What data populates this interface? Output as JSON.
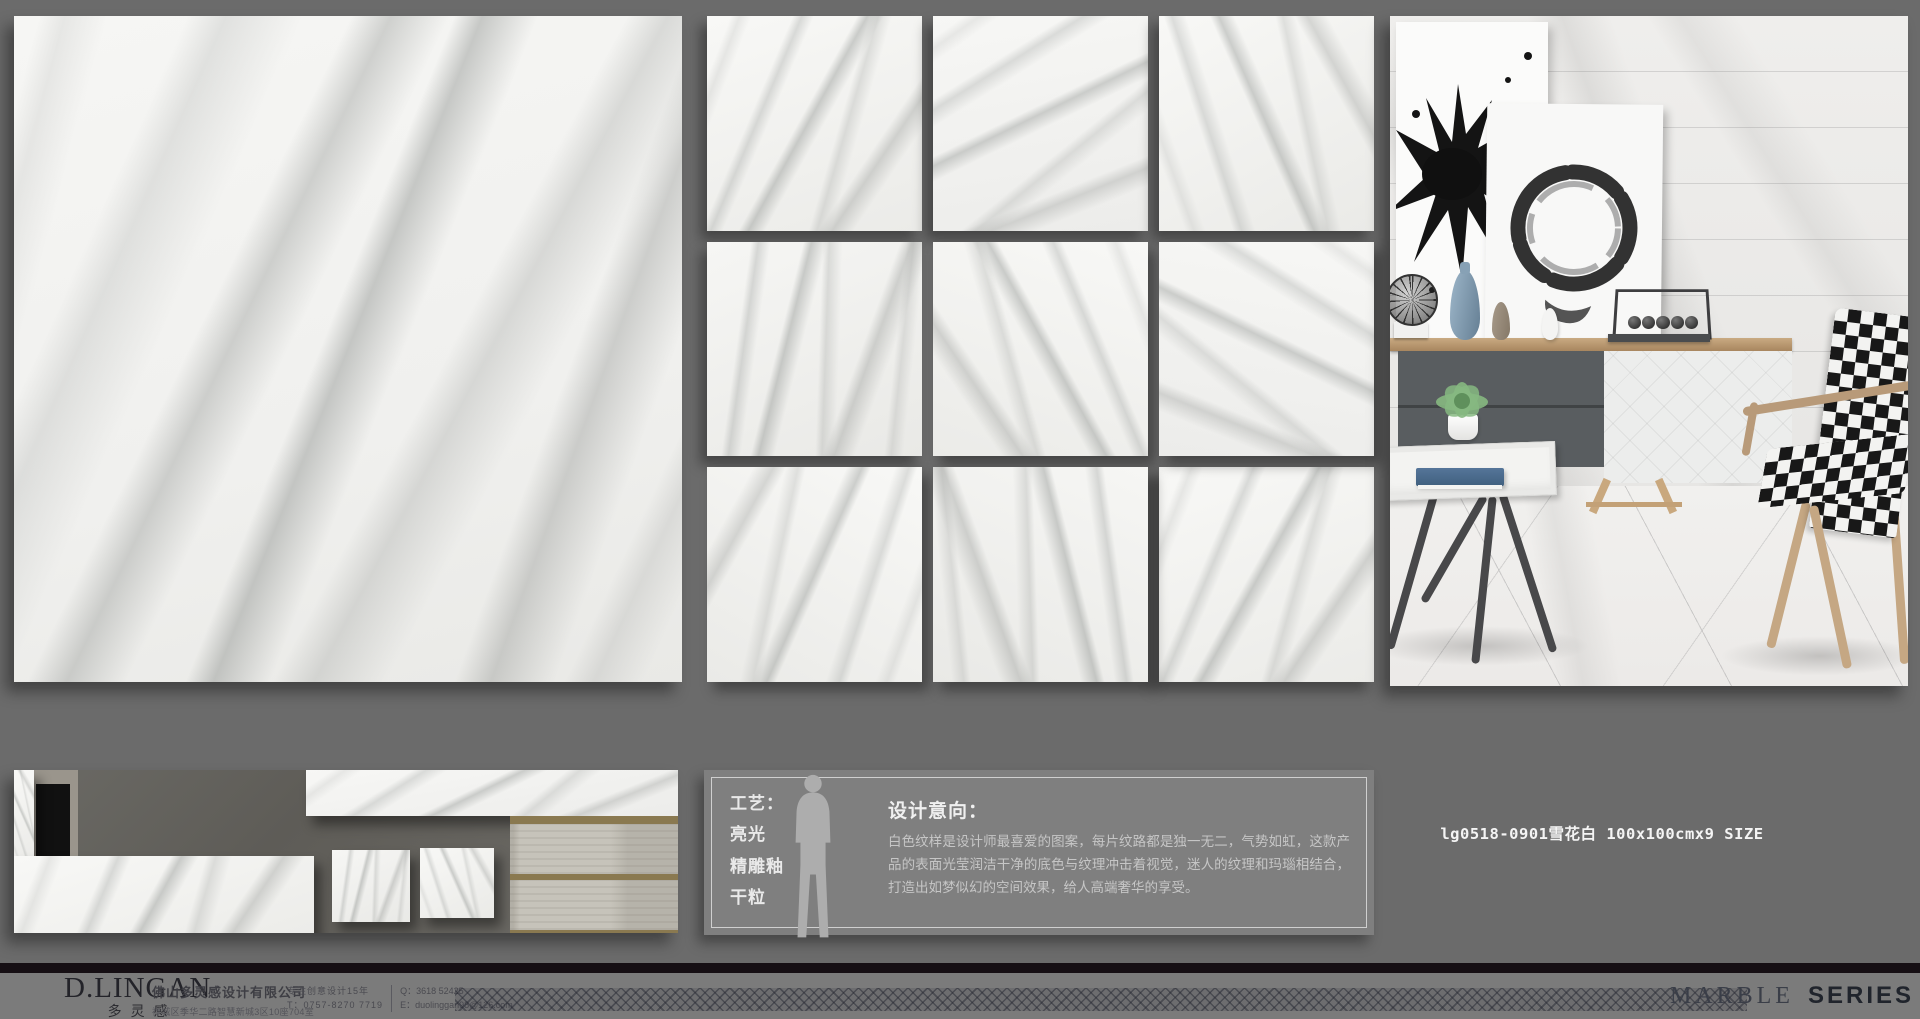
{
  "product": {
    "code_label": "lg0518-0901雪花白 100x100cmx9 SIZE"
  },
  "info_panel": {
    "process_title": "工艺：",
    "process_items": [
      "亮光",
      "精雕釉",
      "干粒"
    ],
    "intent_title": "设计意向：",
    "intent_body": "白色纹样是设计师最喜爱的图案，每片纹路都是独一无二，气势如虹，这款产品的表面光莹润洁干净的底色与纹理冲击着视觉，迷人的纹理和玛瑙相结合，打造出如梦似幻的空间效果，给人高端奢华的享受。"
  },
  "footer": {
    "logo_main": "D.LINGAN",
    "logo_sub": "多灵感",
    "company_name": "佛山多灵感设计有限公司",
    "company_address": "禅城区季华二路智慧新城3区10座704室",
    "slogan": "专注创意设计15年",
    "qq": "Q：3618 52425",
    "tel": "T：0757-8270 7719",
    "email": "E：duolinggan98@126.com",
    "series_word_serif": "MARBLE",
    "series_word_bold": "SERIES"
  },
  "colors": {
    "page_bg": "#6b6b6b",
    "footer_bg": "#7b7b7b",
    "black_bar": "#160f14",
    "info_panel_bg": "#7f7f7f",
    "text_light": "#e9e9e9"
  }
}
